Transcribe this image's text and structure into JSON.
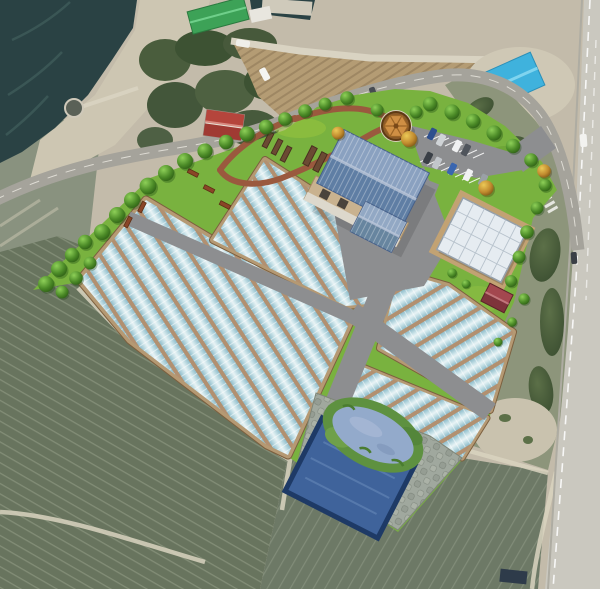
{
  "meta": {
    "title": "Aerial site-plan rendering of a greenhouse farm complex",
    "image_type": "aerial photograph with landscape master-plan overlay",
    "canvas": {
      "width": 600,
      "height": 589
    }
  },
  "palette": {
    "water": "#2a4244",
    "marsh": "#89927f",
    "sand": "#cdc6b2",
    "aerial_trees": "#47593b",
    "tilled_field": "#b49c74",
    "farmland_west": "#68745e",
    "farmland_south": "#6d7966",
    "highway": "#cac8bf",
    "asphalt_road": "#a5a39b",
    "site_lawn": "#79b23f",
    "tree_green": "#3f7d22",
    "autumn_tree": "#c08a2e",
    "greenhouse_tube": "#cfe6eb",
    "tube_gap_tan": "#b29070",
    "block_border": "#b59973",
    "internal_road": "#8d8e90",
    "building_roof_light": "#8aa1c0",
    "building_roof_dark": "#5f7ea4",
    "glass_greenhouse": "#e6ecf1",
    "gazebo_roof": "#cf8f44",
    "trail": "#9a593e",
    "red_shed": "#a3474f",
    "pond_water": "#93aacb",
    "pond_vegetation": "#5e9140",
    "reservoir_water": "#3f639b",
    "reservoir_border": "#1e3a66",
    "plaza_cobble": "#a0a89e",
    "blue_warehouse_roof": "#3fb2dd",
    "green_roof_building": "#3da257",
    "red_roof_house": "#b5453c"
  },
  "counts": {
    "greenhouse_blocks": 4,
    "parked_cars": 9,
    "benches": 5,
    "garden_beds": 7,
    "ponds": 2,
    "rendered_trees": 44
  },
  "features": {
    "scene": {
      "label": "Aerial rendering of planned greenhouse farm beside a river and highway"
    },
    "water": {
      "label": "River water at top left"
    },
    "shore_road": {
      "label": "Shoreline road"
    },
    "wooded_area": {
      "label": "Existing wooded area"
    },
    "red_roof_house": {
      "label": "Existing house with red roof"
    },
    "green_roof_building": {
      "label": "Existing building with green roof"
    },
    "boat": {
      "label": "Small boat on the water"
    },
    "water_tank": {
      "label": "Round tank at the shore"
    },
    "tilled_field": {
      "label": "Tilled brown field"
    },
    "farm_track": {
      "label": "Dirt farm track"
    },
    "blue_warehouse": {
      "label": "Existing warehouse with blue roof"
    },
    "perimeter_road": {
      "label": "Curved perimeter access road"
    },
    "highway": {
      "label": "Multi-lane highway on right edge"
    },
    "crosswalk": {
      "label": "Pedestrian crosswalk at road junction"
    },
    "scrubland": {
      "label": "Scrubland between site and highway"
    },
    "farmland_west": {
      "label": "Dark green farmland, lower left"
    },
    "farmland_south": {
      "label": "Farmland below the site"
    },
    "field_shed": {
      "label": "Dark shed in the field"
    },
    "site": {
      "label": "Proposed greenhouse farm site plan"
    },
    "lawn": {
      "label": "Landscaped lawn with perimeter tree planting"
    },
    "block_a": {
      "label": "Greenhouse block A (south-west, largest)"
    },
    "block_b": {
      "label": "Greenhouse block B (upper middle)"
    },
    "block_c": {
      "label": "Greenhouse block C (east)"
    },
    "block_d": {
      "label": "Greenhouse block D (south-east)"
    },
    "road_main": {
      "label": "Main internal spine road"
    },
    "road_cross": {
      "label": "Internal cross road"
    },
    "parking": {
      "label": "Visitor parking lot"
    },
    "cars": {
      "label": "Parked cars"
    },
    "main_building": {
      "label": "Main building with blue panel roof"
    },
    "glass_greenhouse": {
      "label": "Glass demonstration greenhouse"
    },
    "red_shed": {
      "label": "Small red-roof shed"
    },
    "gazebo": {
      "label": "Hexagonal gazebo"
    },
    "trail": {
      "label": "Red-brown walking trail loop"
    },
    "garden_beds": {
      "label": "Raised garden beds"
    },
    "benches": {
      "label": "Park benches"
    },
    "pond": {
      "label": "Eco pond with planted edge"
    },
    "reservoir": {
      "label": "Rectangular irrigation reservoir"
    },
    "plaza": {
      "label": "Cobbled plaza around pond"
    }
  }
}
